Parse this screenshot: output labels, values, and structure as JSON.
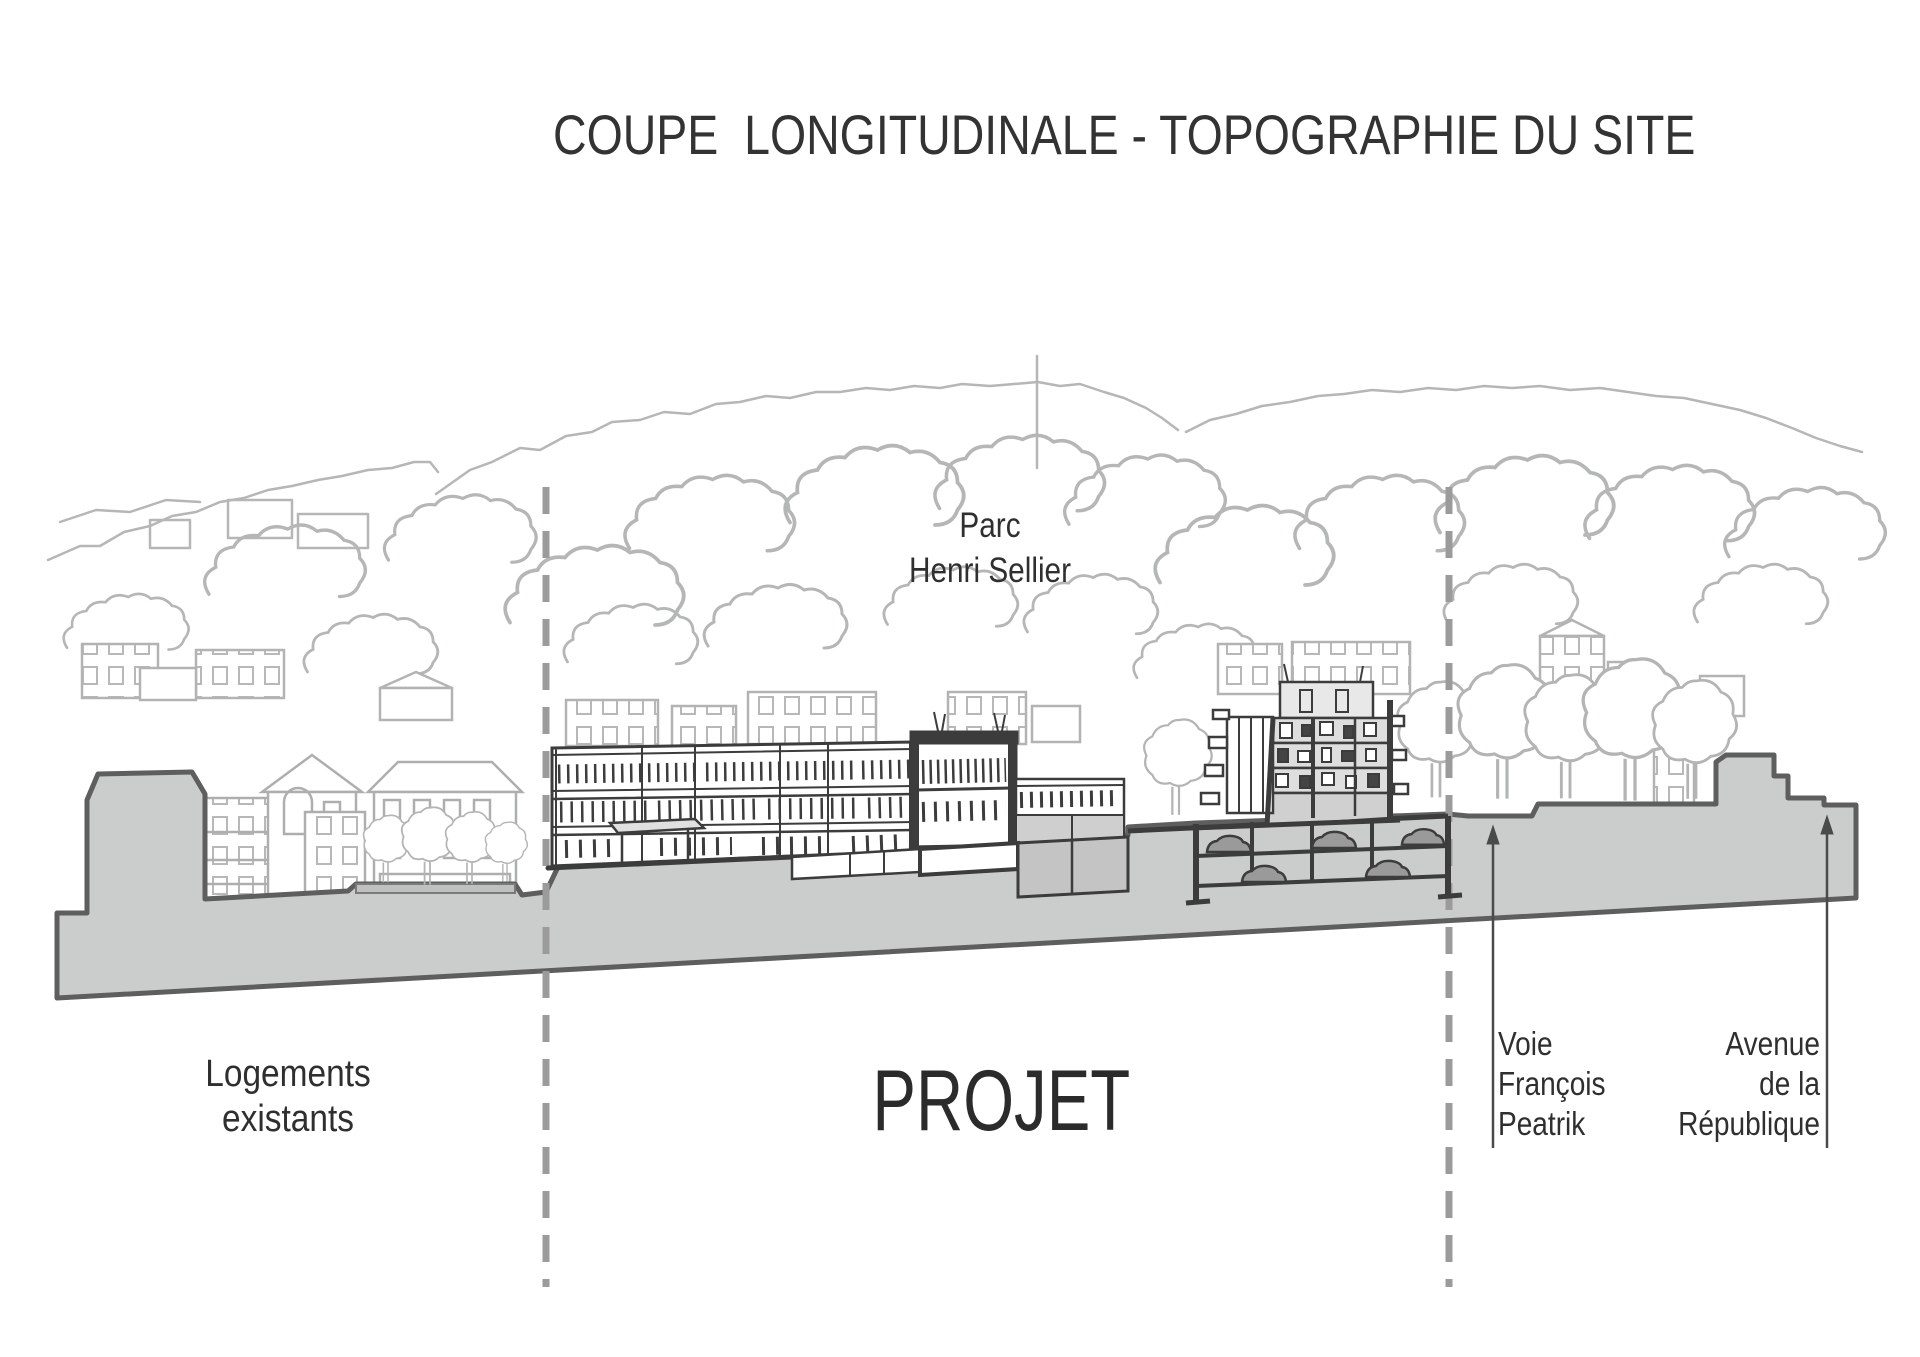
{
  "title": "COUPE  LONGITUDINALE - TOPOGRAPHIE DU SITE",
  "drawing": {
    "type": "architectural-longitudinal-section",
    "labels": {
      "parc": "Parc\nHenri Sellier",
      "logements_existants": "Logements\nexistants",
      "projet": "PROJET",
      "voie_francois_peatrik": "Voie\nFrançois\nPeatrik",
      "avenue_republique": "Avenue\nde la\nRépublique"
    },
    "colors": {
      "ground_fill": "#cbcccc",
      "ground_outline": "#5e5e5e",
      "ink_dark": "#3c3c3c",
      "sketch_light": "#b3b5b4",
      "dashed_line": "#9b9b9b",
      "text": "#2f2f2f"
    }
  }
}
